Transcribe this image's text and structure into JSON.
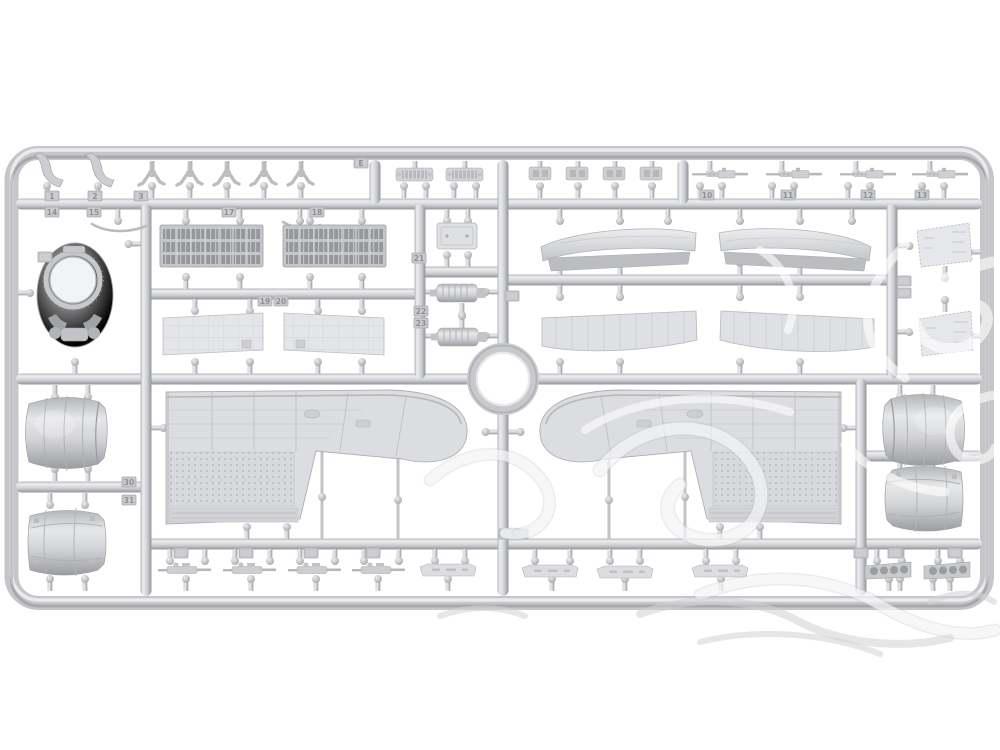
{
  "image": {
    "type": "product-photo",
    "subject": "light-gray injection-molded plastic model kit sprue with aircraft parts on white background",
    "background_color": "#ffffff"
  },
  "sprue": {
    "letter_tag": "E",
    "plastic_color": "#d3d4d7",
    "highlight_color": "#eeeff1",
    "shadow_color": "#96979b",
    "detail_dark_color": "#9a9b9f",
    "features": [
      "rounded-rectangular-frame",
      "center-ring-hub",
      "internal-runner-grid",
      "molded-part-number-tags"
    ]
  },
  "watermark": {
    "description": "translucent white decorative swirl watermark over right half, gray swirl tails below frame",
    "color_over_plastic": "#ffffff",
    "color_over_background": "#d4d5d9",
    "opacity": 0.55
  },
  "part_tags": [
    {
      "label": "E"
    },
    {
      "label": "1"
    },
    {
      "label": "2"
    },
    {
      "label": "3"
    },
    {
      "label": "14"
    },
    {
      "label": "15"
    },
    {
      "label": "17"
    },
    {
      "label": "18"
    },
    {
      "label": "19"
    },
    {
      "label": "20"
    },
    {
      "label": "21"
    },
    {
      "label": "22"
    },
    {
      "label": "23"
    },
    {
      "label": "30"
    },
    {
      "label": "31"
    },
    {
      "label": "10"
    },
    {
      "label": "11"
    },
    {
      "label": "12"
    },
    {
      "label": "13"
    }
  ],
  "parts_inventory": [
    {
      "name": "curved horn bracket",
      "count": 2
    },
    {
      "name": "forked bracket",
      "count": 5
    },
    {
      "name": "ribbed fitting block",
      "count": 2
    },
    {
      "name": "small detail block",
      "count": 4
    },
    {
      "name": "machine gun",
      "count": 4
    },
    {
      "name": "thin curved rod",
      "count": 2
    },
    {
      "name": "louvered cowl-flap panel",
      "count": 2
    },
    {
      "name": "riveted access panel",
      "count": 2
    },
    {
      "name": "engine cowl front ring",
      "count": 1
    },
    {
      "name": "hatch door",
      "count": 1
    },
    {
      "name": "cylindrical accessory unit",
      "count": 2
    },
    {
      "name": "stabilizer half with elevator strip",
      "count": 2
    },
    {
      "name": "stabilizer lower half",
      "count": 2
    },
    {
      "name": "trapezoid wing panel",
      "count": 2
    },
    {
      "name": "engine cowling barrel",
      "count": 4
    },
    {
      "name": "upper wing half",
      "count": 2
    },
    {
      "name": "twin-gun mount",
      "count": 4
    },
    {
      "name": "access panel strip",
      "count": 4
    },
    {
      "name": "exhaust manifold with four ports",
      "count": 2
    }
  ]
}
